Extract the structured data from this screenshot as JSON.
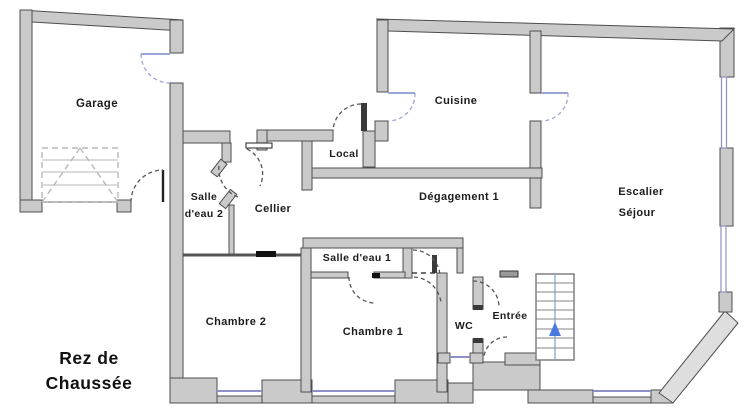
{
  "title": {
    "line1": "Rez de",
    "line2": "Chaussée"
  },
  "rooms": {
    "garage": "Garage",
    "salle_deau_2_line1": "Salle",
    "salle_deau_2_line2": "d'eau 2",
    "cellier": "Cellier",
    "local": "Local",
    "cuisine": "Cuisine",
    "degagement": "Dégagement 1",
    "escalier": "Escalier",
    "sejour": "Séjour",
    "salle_deau_1": "Salle d'eau 1",
    "chambre_2": "Chambre 2",
    "chambre_1": "Chambre 1",
    "wc": "WC",
    "entree": "Entrée"
  },
  "icons": {
    "stairs_arrow_icon": "triangle-up"
  },
  "colors": {
    "background": "#ffffff",
    "wall_fill": "#cacaca",
    "wall_stroke": "#4d4d4d",
    "bay_wall_fill": "#dedede",
    "window_blue": "#8f8fc8",
    "door_arc_blue": "#9aa6d6",
    "door_arc_dark": "#555555",
    "stairs_arrow_blue": "#4a7ae0",
    "text_color": "#1c1c1c"
  }
}
